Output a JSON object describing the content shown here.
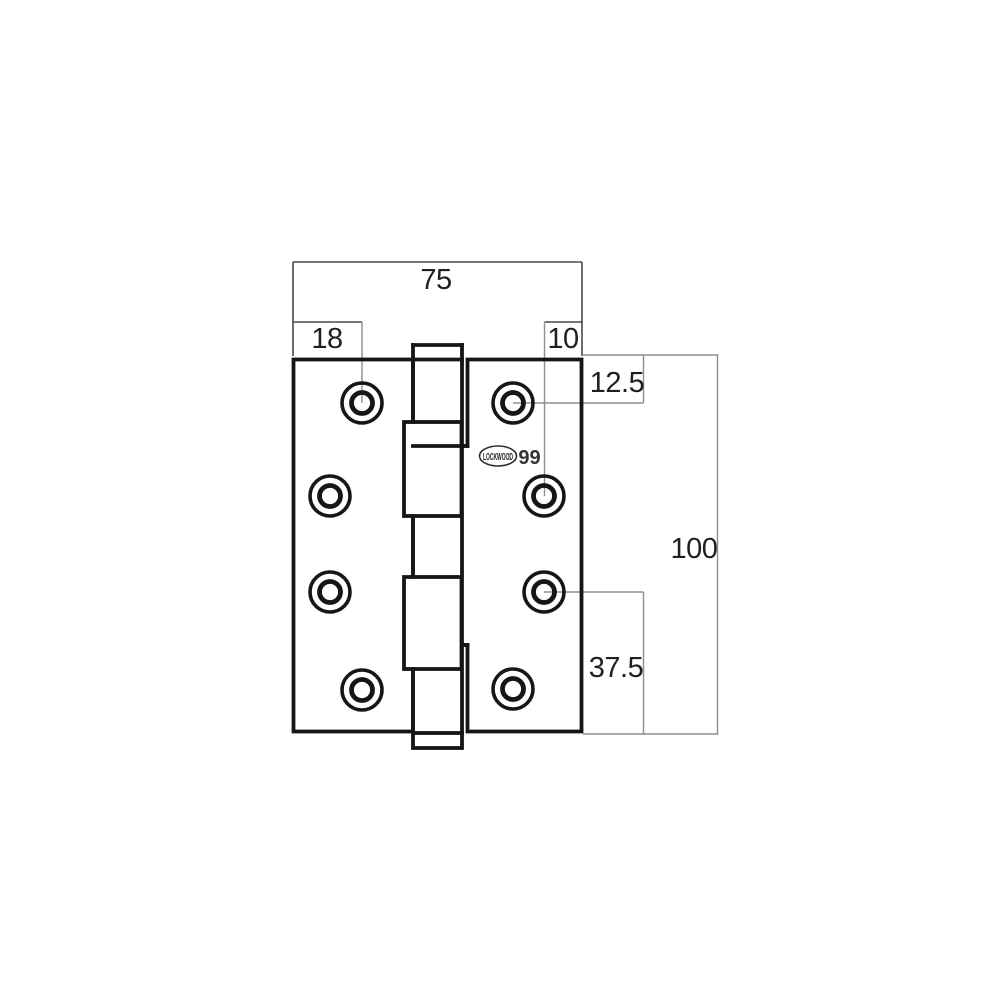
{
  "drawing": {
    "type": "hinge technical drawing",
    "logo": {
      "brand": "LOCKWOOD",
      "model_number": "99"
    },
    "dimension_labels": {
      "overall_width": "75",
      "left_edge_to_hole": "18",
      "right_edge_to_hole": "10",
      "top_edge_to_hole": "12.5",
      "overall_height": "100",
      "hole_to_bottom_edge": "37.5"
    },
    "colors": {
      "outline": "#161616",
      "dimension_dark": "#4a4a4a",
      "dimension_light": "#8f8f8f",
      "label_text": "#1f1f1f",
      "logo_stroke": "#2e2e2e"
    }
  }
}
